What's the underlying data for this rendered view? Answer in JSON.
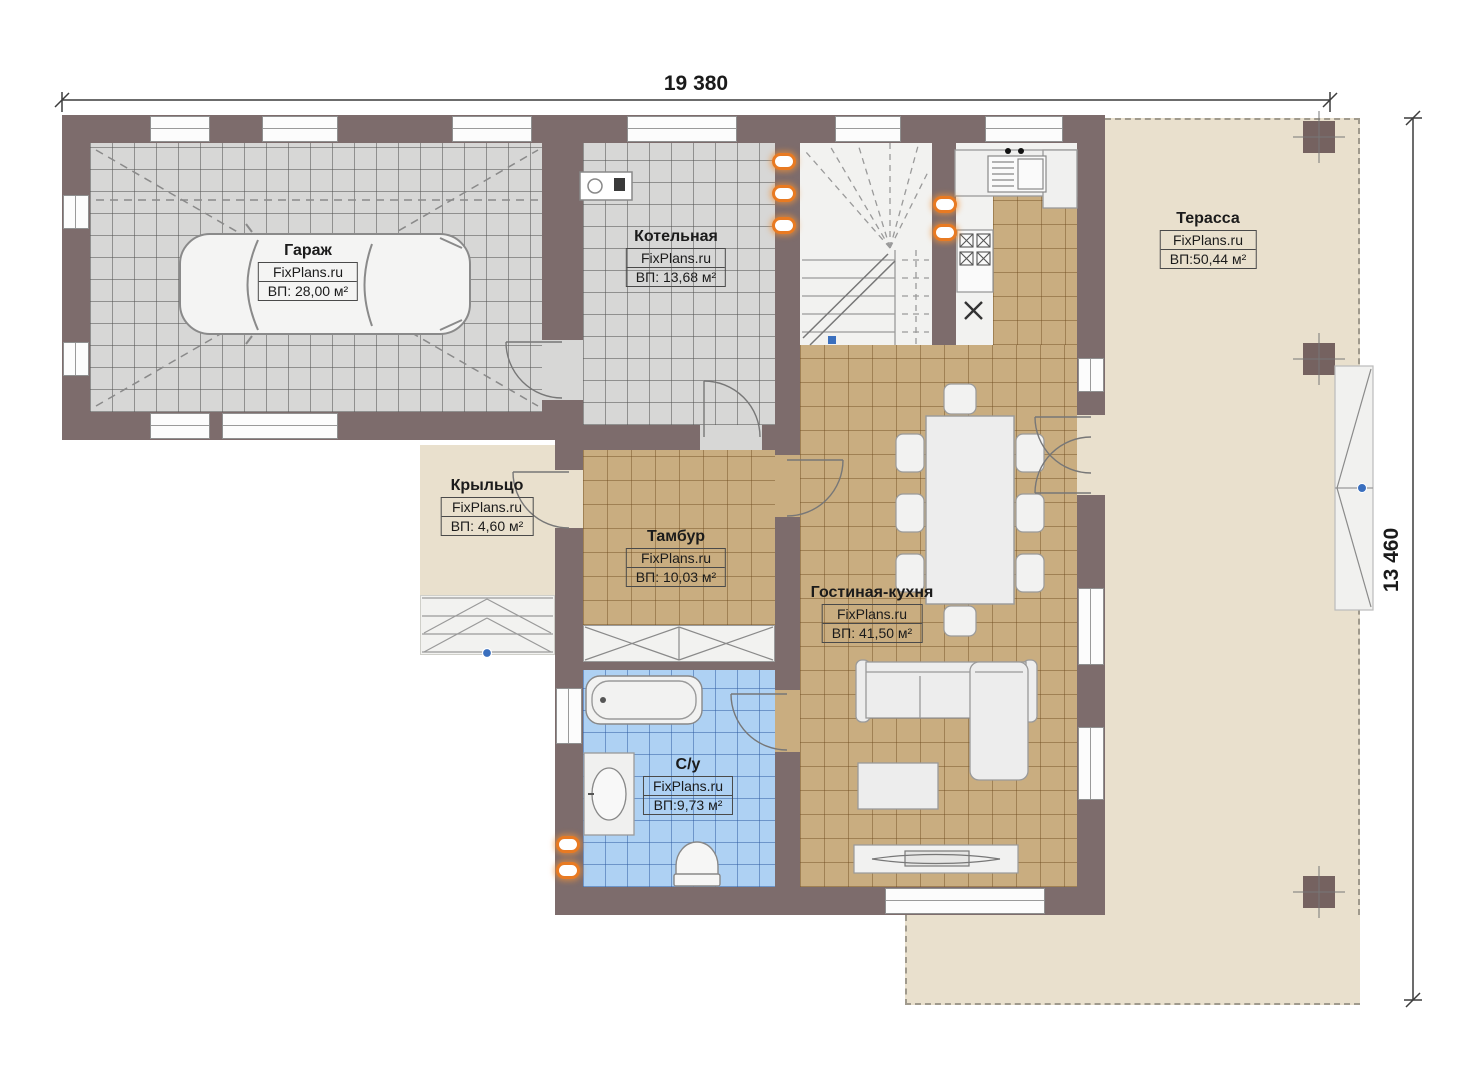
{
  "plan": {
    "brand": "FixPlans.ru",
    "dimensions": {
      "width_label": "19 380",
      "height_label": "13 460"
    },
    "rooms": {
      "garage": {
        "name": "Гараж",
        "brand": "FixPlans.ru",
        "area": "ВП: 28,00 м²"
      },
      "boiler": {
        "name": "Котельная",
        "brand": "FixPlans.ru",
        "area": "ВП: 13,68 м²"
      },
      "terrace": {
        "name": "Терасса",
        "brand": "FixPlans.ru",
        "area": "ВП:50,44 м²"
      },
      "porch": {
        "name": "Крыльцо",
        "brand": "FixPlans.ru",
        "area": "ВП: 4,60 м²"
      },
      "vestibule": {
        "name": "Тамбур",
        "brand": "FixPlans.ru",
        "area": "ВП: 10,03 м²"
      },
      "living_kitchen": {
        "name": "Гостиная-кухня",
        "brand": "FixPlans.ru",
        "area": "ВП: 41,50 м²"
      },
      "bathroom": {
        "name": "С/у",
        "brand": "FixPlans.ru",
        "area": "ВП:9,73 м²"
      }
    },
    "colors": {
      "wall": "#7d6c6c",
      "floor_gray": "#d7d7d6",
      "floor_tan": "#c9ad80",
      "floor_blue": "#aed1f3",
      "floor_beige": "#e9e0cd",
      "radiator": "#e87a22"
    }
  }
}
